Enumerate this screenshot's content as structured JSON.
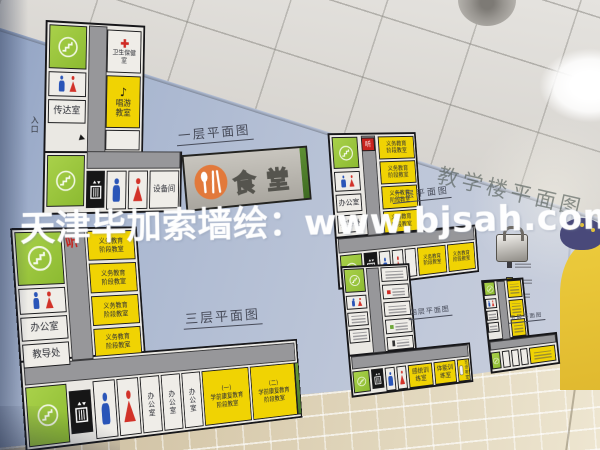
{
  "scene": {
    "watermark": "天津毕加索墙绘：www.bjsah.com",
    "wall_title": "教学楼平面图"
  },
  "icons": {
    "music_note": "♪",
    "entrance_arrow": "▶"
  },
  "colors": {
    "stairwell_green": "#93c13c",
    "classroom_yellow": "#f0d303",
    "corridor_gray": "#97979a",
    "male_blue": "#2a55b8",
    "female_red": "#d23229",
    "canteen_orange": "#e2793b",
    "cross_red": "#cf2a24"
  },
  "floors": [
    {
      "label": "一层平面图",
      "entrance_label": "入口",
      "rooms": {
        "reception": "传达室",
        "health": "卫生保健室",
        "music": "唱游教室",
        "equipment": "设备间",
        "canteen": "食堂"
      }
    },
    {
      "label": "二层平面图",
      "corridor_mark": "听",
      "rooms": {
        "office": "办公室",
        "dean": "教导处",
        "classroom": "义务教育阶段教室"
      }
    },
    {
      "label": "三层平面图",
      "corridor_mark": "听",
      "rooms": {
        "office": "办公室",
        "dean": "教导处",
        "classroom": "义务教育阶段教室",
        "office_vertical": "办公室",
        "preschool1_no": "(一)",
        "preschool1": "学前康复教育阶段教室",
        "preschool2_no": "(二)",
        "preschool2": "学前康复教育阶段教室"
      }
    },
    {
      "label": "四层平面图",
      "rooms": {
        "sensory": "感统训练室",
        "physical": "体能训练室",
        "speech": "言语教室"
      }
    },
    {
      "label": "五层平面图"
    }
  ]
}
